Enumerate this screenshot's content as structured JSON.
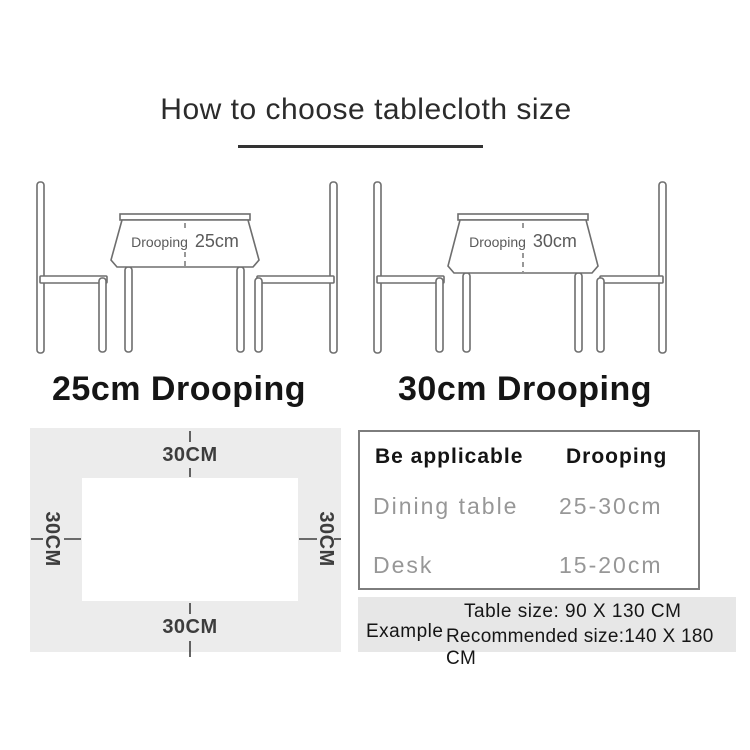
{
  "title": "How to choose tablecloth size",
  "diagrams": [
    {
      "droop_prefix": "Drooping",
      "droop_value": "25cm",
      "caption": "25cm Drooping"
    },
    {
      "droop_prefix": "Drooping",
      "droop_value": "30cm",
      "caption": "30cm Drooping"
    }
  ],
  "size_panel": {
    "top": "30CM",
    "right": "30CM",
    "bottom": "30CM",
    "left": "30CM"
  },
  "spec_table": {
    "col1_header": "Be applicable",
    "col2_header": "Drooping",
    "rows": [
      {
        "label": "Dining table",
        "value": "25-30cm"
      },
      {
        "label": "Desk",
        "value": "15-20cm"
      }
    ]
  },
  "example": {
    "label": "Example",
    "line1": "Table size:  90 X 130 CM",
    "line2": "Recommended size:140 X 180 CM"
  },
  "colors": {
    "line_art": "#6e6e6e",
    "panel_bg": "#ececec",
    "example_bg": "#e7e7e7",
    "muted_text": "#979797",
    "ink": "#1c1c1c"
  }
}
